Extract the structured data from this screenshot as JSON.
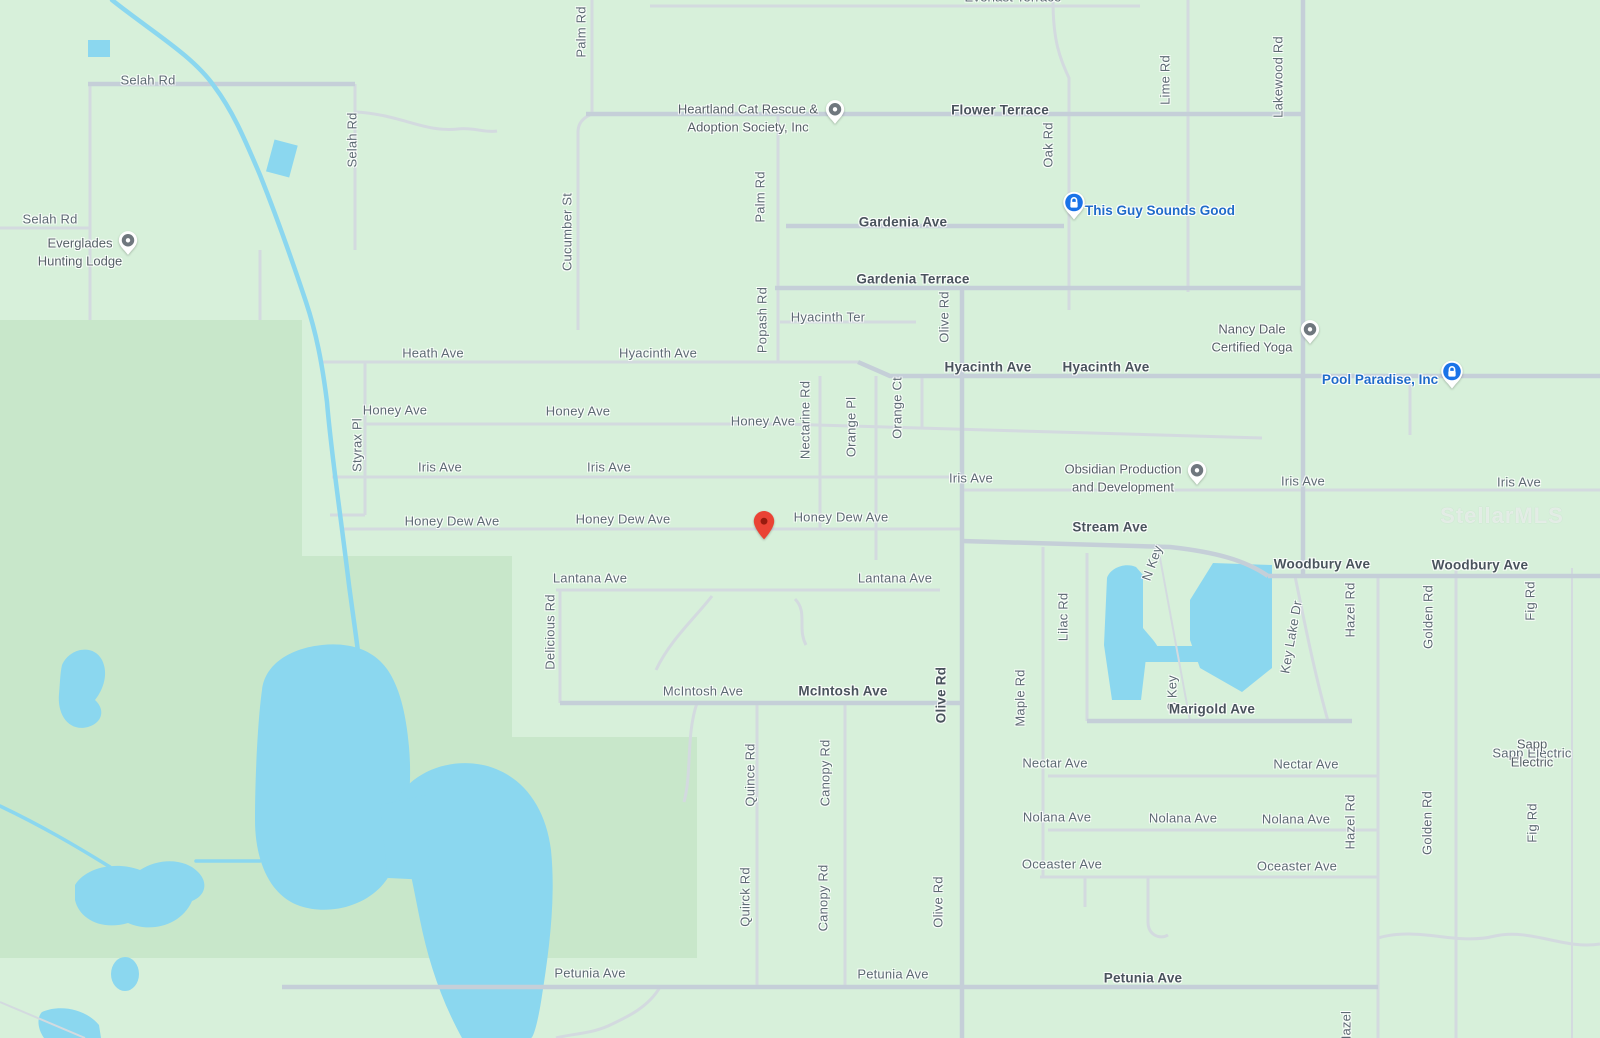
{
  "map_colors": {
    "background_green": "#d7f0da",
    "park_green": "#c8e7ca",
    "water_blue": "#8bd7ef",
    "road_minor": "#d3dadf",
    "road_major": "#c5cfd8",
    "street_label": "#5d6a73",
    "street_label_strong": "#49535c",
    "poi_gray": "#556066",
    "poi_blue": "#1f6bc9",
    "pin_red": "#EA4335",
    "watermark": "rgba(255,255,255,0.55)"
  },
  "watermark_text": "StellarMLS",
  "streets": [
    {
      "text": "Selah Rd",
      "x": 148,
      "y": 80,
      "rot": 0,
      "strong": false
    },
    {
      "text": "Selah Rd",
      "x": 50,
      "y": 219,
      "rot": 0,
      "strong": false
    },
    {
      "text": "Selah Rd",
      "x": 352,
      "y": 140,
      "rot": -90,
      "strong": false
    },
    {
      "text": "Palm Rd",
      "x": 581,
      "y": 32,
      "rot": -90,
      "strong": false
    },
    {
      "text": "Everlast Terrace",
      "x": 1013,
      "y": -3,
      "rot": 0,
      "strong": false
    },
    {
      "text": "Flower Terrace",
      "x": 1000,
      "y": 110,
      "rot": 0,
      "strong": true
    },
    {
      "text": "Oak Rd",
      "x": 1048,
      "y": 145,
      "rot": -90,
      "strong": false
    },
    {
      "text": "Lime Rd",
      "x": 1165,
      "y": 80,
      "rot": -90,
      "strong": false
    },
    {
      "text": "Lakewood Rd",
      "x": 1278,
      "y": 77,
      "rot": -90,
      "strong": false
    },
    {
      "text": "Palm Rd",
      "x": 760,
      "y": 197,
      "rot": -90,
      "strong": false
    },
    {
      "text": "Cucumber St",
      "x": 567,
      "y": 232,
      "rot": -90,
      "strong": false
    },
    {
      "text": "Gardenia Ave",
      "x": 903,
      "y": 222,
      "rot": 0,
      "strong": true
    },
    {
      "text": "Gardenia Terrace",
      "x": 913,
      "y": 279,
      "rot": 0,
      "strong": true
    },
    {
      "text": "Hyacinth Ter",
      "x": 828,
      "y": 317,
      "rot": 0,
      "strong": false
    },
    {
      "text": "Popash Rd",
      "x": 762,
      "y": 320,
      "rot": -90,
      "strong": false
    },
    {
      "text": "Olive Rd",
      "x": 944,
      "y": 317,
      "rot": -90,
      "strong": false
    },
    {
      "text": "Heath Ave",
      "x": 433,
      "y": 353,
      "rot": 0,
      "strong": false
    },
    {
      "text": "Hyacinth Ave",
      "x": 658,
      "y": 353,
      "rot": 0,
      "strong": false
    },
    {
      "text": "Hyacinth Ave",
      "x": 988,
      "y": 367,
      "rot": 0,
      "strong": true
    },
    {
      "text": "Hyacinth Ave",
      "x": 1106,
      "y": 367,
      "rot": 0,
      "strong": true
    },
    {
      "text": "Honey Ave",
      "x": 395,
      "y": 410,
      "rot": 0,
      "strong": false
    },
    {
      "text": "Honey Ave",
      "x": 578,
      "y": 411,
      "rot": 0,
      "strong": false
    },
    {
      "text": "Honey Ave",
      "x": 763,
      "y": 421,
      "rot": 0,
      "strong": false
    },
    {
      "text": "Styrax Pl",
      "x": 357,
      "y": 445,
      "rot": -90,
      "strong": false
    },
    {
      "text": "Nectarine Rd",
      "x": 805,
      "y": 420,
      "rot": -90,
      "strong": false
    },
    {
      "text": "Orange Pl",
      "x": 851,
      "y": 427,
      "rot": -90,
      "strong": false
    },
    {
      "text": "Orange Ct",
      "x": 897,
      "y": 408,
      "rot": -90,
      "strong": false
    },
    {
      "text": "Iris Ave",
      "x": 440,
      "y": 467,
      "rot": 0,
      "strong": false
    },
    {
      "text": "Iris Ave",
      "x": 609,
      "y": 467,
      "rot": 0,
      "strong": false
    },
    {
      "text": "Iris Ave",
      "x": 971,
      "y": 478,
      "rot": 0,
      "strong": false
    },
    {
      "text": "Iris Ave",
      "x": 1303,
      "y": 481,
      "rot": 0,
      "strong": false
    },
    {
      "text": "Iris Ave",
      "x": 1519,
      "y": 482,
      "rot": 0,
      "strong": false
    },
    {
      "text": "Honey Dew Ave",
      "x": 452,
      "y": 521,
      "rot": 0,
      "strong": false
    },
    {
      "text": "Honey Dew Ave",
      "x": 623,
      "y": 519,
      "rot": 0,
      "strong": false
    },
    {
      "text": "Honey Dew Ave",
      "x": 841,
      "y": 517,
      "rot": 0,
      "strong": false
    },
    {
      "text": "Stream Ave",
      "x": 1110,
      "y": 527,
      "rot": 0,
      "strong": true
    },
    {
      "text": "Woodbury Ave",
      "x": 1322,
      "y": 564,
      "rot": 0,
      "strong": true
    },
    {
      "text": "Woodbury Ave",
      "x": 1480,
      "y": 565,
      "rot": 0,
      "strong": true
    },
    {
      "text": "Lantana Ave",
      "x": 590,
      "y": 578,
      "rot": 0,
      "strong": false
    },
    {
      "text": "Lantana Ave",
      "x": 895,
      "y": 578,
      "rot": 0,
      "strong": false
    },
    {
      "text": "Delicious Rd",
      "x": 550,
      "y": 632,
      "rot": -90,
      "strong": false
    },
    {
      "text": "Lilac Rd",
      "x": 1063,
      "y": 617,
      "rot": -90,
      "strong": false
    },
    {
      "text": "N Key",
      "x": 1152,
      "y": 563,
      "rot": -70,
      "strong": false
    },
    {
      "text": "Key Lake Dr",
      "x": 1291,
      "y": 637,
      "rot": -80,
      "strong": false
    },
    {
      "text": "Hazel Rd",
      "x": 1350,
      "y": 610,
      "rot": -90,
      "strong": false
    },
    {
      "text": "Golden Rd",
      "x": 1428,
      "y": 617,
      "rot": -90,
      "strong": false
    },
    {
      "text": "Fig Rd",
      "x": 1530,
      "y": 601,
      "rot": -90,
      "strong": false
    },
    {
      "text": "McIntosh Ave",
      "x": 703,
      "y": 691,
      "rot": 0,
      "strong": false
    },
    {
      "text": "McIntosh Ave",
      "x": 843,
      "y": 691,
      "rot": 0,
      "strong": true
    },
    {
      "text": "Olive Rd",
      "x": 941,
      "y": 695,
      "rot": -90,
      "strong": true
    },
    {
      "text": "Maple Rd",
      "x": 1020,
      "y": 698,
      "rot": -90,
      "strong": false
    },
    {
      "text": "S Key",
      "x": 1172,
      "y": 693,
      "rot": -90,
      "strong": false
    },
    {
      "text": "Marigold Ave",
      "x": 1212,
      "y": 709,
      "rot": 0,
      "strong": true
    },
    {
      "text": "Quince Rd",
      "x": 750,
      "y": 775,
      "rot": -90,
      "strong": false
    },
    {
      "text": "Canopy Rd",
      "x": 825,
      "y": 773,
      "rot": -90,
      "strong": false
    },
    {
      "text": "Nectar Ave",
      "x": 1055,
      "y": 763,
      "rot": 0,
      "strong": false
    },
    {
      "text": "Nectar Ave",
      "x": 1306,
      "y": 764,
      "rot": 0,
      "strong": false
    },
    {
      "text": "Nolana Ave",
      "x": 1057,
      "y": 817,
      "rot": 0,
      "strong": false
    },
    {
      "text": "Nolana Ave",
      "x": 1183,
      "y": 818,
      "rot": 0,
      "strong": false
    },
    {
      "text": "Nolana Ave",
      "x": 1296,
      "y": 819,
      "rot": 0,
      "strong": false
    },
    {
      "text": "Oceaster Ave",
      "x": 1062,
      "y": 864,
      "rot": 0,
      "strong": false
    },
    {
      "text": "Oceaster Ave",
      "x": 1297,
      "y": 866,
      "rot": 0,
      "strong": false
    },
    {
      "text": "Hazel Rd",
      "x": 1350,
      "y": 822,
      "rot": -90,
      "strong": false
    },
    {
      "text": "Golden Rd",
      "x": 1427,
      "y": 823,
      "rot": -90,
      "strong": false
    },
    {
      "text": "Fig Rd",
      "x": 1532,
      "y": 823,
      "rot": -90,
      "strong": false
    },
    {
      "text": "Quirck Rd",
      "x": 745,
      "y": 897,
      "rot": -90,
      "strong": false
    },
    {
      "text": "Canopy Rd",
      "x": 823,
      "y": 898,
      "rot": -90,
      "strong": false
    },
    {
      "text": "Olive Rd",
      "x": 938,
      "y": 902,
      "rot": -90,
      "strong": false
    },
    {
      "text": "Petunia Ave",
      "x": 590,
      "y": 973,
      "rot": 0,
      "strong": false
    },
    {
      "text": "Petunia Ave",
      "x": 893,
      "y": 974,
      "rot": 0,
      "strong": false
    },
    {
      "text": "Petunia Ave",
      "x": 1143,
      "y": 978,
      "rot": 0,
      "strong": true
    },
    {
      "text": "Hazel",
      "x": 1346,
      "y": 1028,
      "rot": -90,
      "strong": false
    },
    {
      "text": "Sapp Electric",
      "x": 1532,
      "y": 753,
      "rot": 0,
      "strong": false
    }
  ],
  "pois": [
    {
      "id": "everglades-hunting-lodge",
      "text": "Everglades\nHunting Lodge",
      "x": 80,
      "y": 252,
      "style": "gray",
      "marker": "gray-pin",
      "mx": 128,
      "my": 248
    },
    {
      "id": "heartland-cat-rescue",
      "text": "Heartland Cat Rescue &\nAdoption Society, Inc",
      "x": 748,
      "y": 118,
      "style": "gray",
      "marker": "gray-pin",
      "mx": 835,
      "my": 117
    },
    {
      "id": "this-guy-sounds-good",
      "text": "This Guy Sounds Good",
      "x": 1160,
      "y": 211,
      "style": "blue",
      "marker": "blue-badge",
      "mx": 1074,
      "my": 211
    },
    {
      "id": "nancy-dale-certified-yoga",
      "text": "Nancy Dale\nCertified Yoga",
      "x": 1252,
      "y": 338,
      "style": "gray",
      "marker": "gray-pin",
      "mx": 1310,
      "my": 337
    },
    {
      "id": "pool-paradise-inc",
      "text": "Pool Paradise, Inc",
      "x": 1380,
      "y": 380,
      "style": "blue",
      "marker": "blue-badge",
      "mx": 1452,
      "my": 380
    },
    {
      "id": "obsidian-production",
      "text": "Obsidian Production\nand Development",
      "x": 1123,
      "y": 478,
      "style": "gray",
      "marker": "gray-pin",
      "mx": 1197,
      "my": 478
    },
    {
      "id": "sapp-electric",
      "text": "Sapp Electric",
      "x": 1532,
      "y": 753,
      "style": "gray",
      "marker": "none",
      "mx": 0,
      "my": 0
    }
  ],
  "dropped_pin": {
    "x": 764,
    "y": 531
  }
}
